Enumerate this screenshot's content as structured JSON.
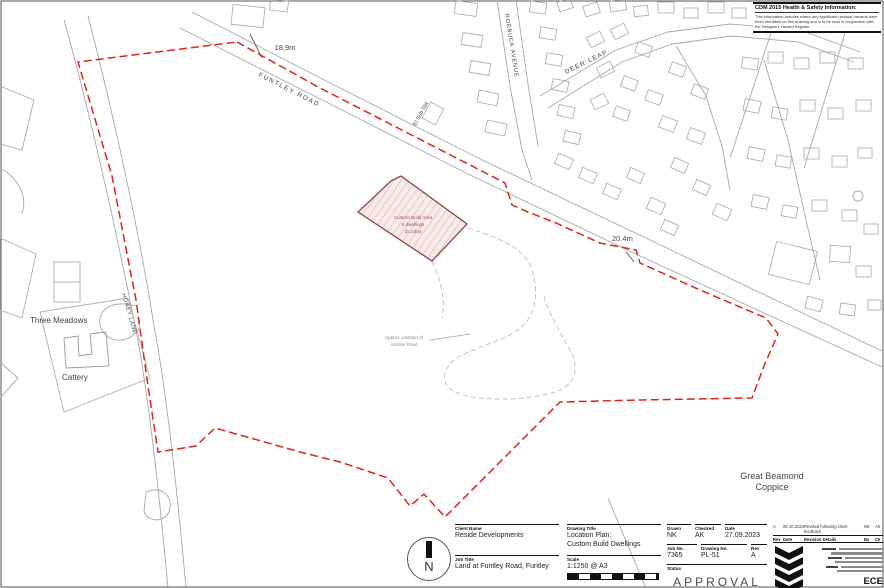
{
  "cdm": {
    "title": "CDM 2015 Health & Safety Information:",
    "body": "This information denotes where any significant residual hazards have been identified on this drawing and is to be read in conjunction with the Designers Hazard Register."
  },
  "map": {
    "labels": {
      "funtley_road": "FUNTLEY ROAD",
      "roebuck_avenue": "ROEBUCK AVENUE",
      "deer_leap": "DEER LEAP",
      "honey_lane": "HONEY LANE",
      "el_sub_sta": "El Sub Sta",
      "three_meadows": "Three Meadows",
      "cattery": "Cattery",
      "coppice_line1": "Great Beamond",
      "coppice_line2": "Coppice",
      "dim_north": "18.9m",
      "dim_east": "20.4m",
      "custom_line1": "Custom Build Area",
      "custom_line2": "5 dwellings",
      "custom_line3": "(0.14ha)",
      "note_line1": "Approx. position of",
      "note_line2": "Access Road"
    },
    "colors": {
      "boundary": "#e02318",
      "hatch_fill": "#f8ebe9",
      "hatch_line": "#dba8a2",
      "hatch_outline": "#8a4540",
      "map_grey": "#a8a8a8"
    }
  },
  "titleblock": {
    "client_label": "Client Name",
    "client": "Reside Developments",
    "job_title_label": "Job Title",
    "job_title": "Land at Funtley Road, Funtley",
    "drawing_title_label": "Drawing Title",
    "drawing_title_1": "Location Plan:",
    "drawing_title_2": "Custom Build Dwellings",
    "scale_label": "Scale",
    "scale": "1:1250 @ A3",
    "drawn_label": "Drawn",
    "drawn": "NK",
    "checked_label": "Checked",
    "checked": "AK",
    "date_label": "Date",
    "date": "27.09.2023",
    "job_no_label": "Job No.",
    "job_no": "7365",
    "drawing_no_label": "Drawing No.",
    "drawing_no": "PL-51",
    "rev_label": "Rev",
    "rev": "A",
    "status_label": "Status",
    "status": "APPROVAL",
    "north": "N"
  },
  "revisions": {
    "entry": {
      "rev": "A",
      "date": "06.10.2023",
      "details": "Revised following client feedback",
      "by": "NK",
      "ck": "AK"
    },
    "headers": {
      "rev": "Rev",
      "date": "Date",
      "details": "Revision Details",
      "by": "By",
      "ck": "Ck"
    }
  },
  "firm": {
    "name": "ECE Architecture"
  }
}
